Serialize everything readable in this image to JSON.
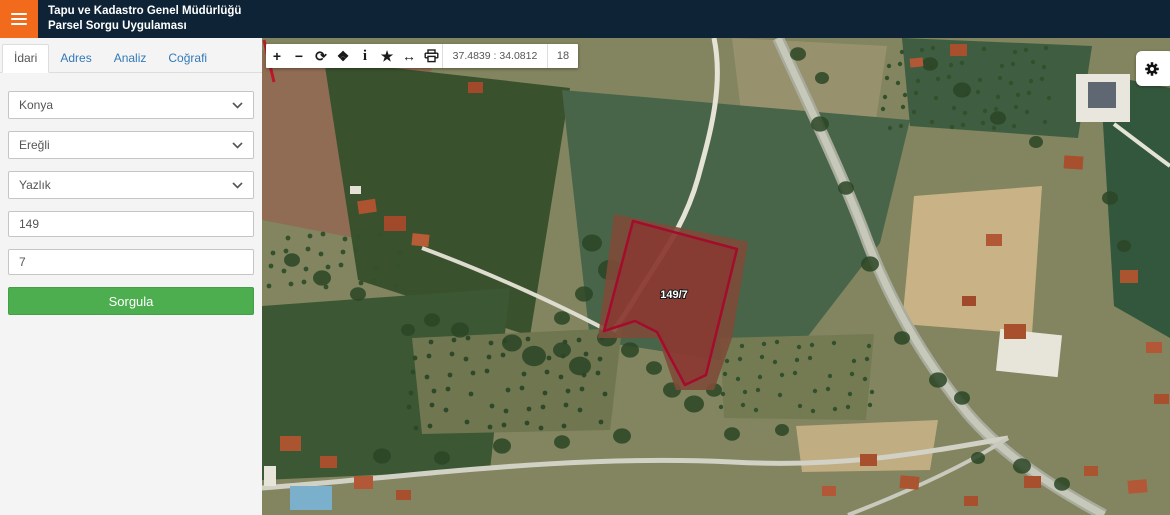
{
  "header": {
    "title_line1": "Tapu ve Kadastro Genel Müdürlüğü",
    "title_line2": "Parsel Sorgu Uygulaması"
  },
  "sidebar": {
    "tabs": [
      {
        "label": "İdari",
        "active": true
      },
      {
        "label": "Adres",
        "active": false
      },
      {
        "label": "Analiz",
        "active": false
      },
      {
        "label": "Coğrafi",
        "active": false
      }
    ],
    "selects": [
      {
        "name": "il",
        "value": "Konya"
      },
      {
        "name": "ilce",
        "value": "Ereğli"
      },
      {
        "name": "mahalle",
        "value": "Yazlık"
      }
    ],
    "inputs": [
      {
        "name": "ada",
        "value": "149"
      },
      {
        "name": "parsel",
        "value": "7"
      }
    ],
    "query_button_label": "Sorgula"
  },
  "map": {
    "toolbar": {
      "buttons": [
        {
          "name": "zoom-in",
          "glyph": "+"
        },
        {
          "name": "zoom-out",
          "glyph": "−"
        },
        {
          "name": "refresh",
          "glyph": "⟳"
        },
        {
          "name": "pan",
          "glyph": "❖"
        },
        {
          "name": "info",
          "glyph": "i"
        },
        {
          "name": "favorite",
          "glyph": "★"
        },
        {
          "name": "measure",
          "glyph": "↔"
        },
        {
          "name": "print",
          "glyph": ""
        }
      ],
      "coordinates": "37.4839 : 34.0812",
      "zoom_level": "18"
    },
    "parcel_label": "149/7",
    "colors": {
      "parcel_stroke": "#a30c2c",
      "parcel_fill": "#9e1c28"
    }
  },
  "colors": {
    "accent_orange": "#f26b1d",
    "navbar": "#0e2436",
    "button_green": "#4cae4f",
    "link_blue": "#337ab7"
  }
}
